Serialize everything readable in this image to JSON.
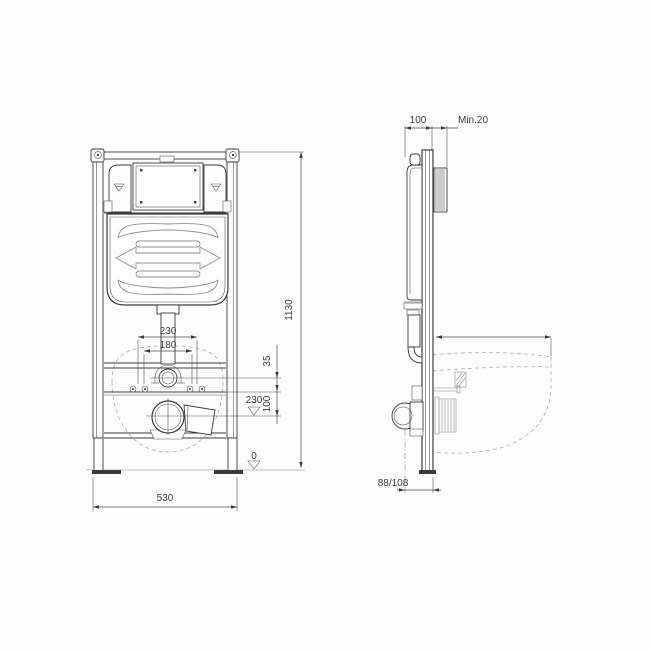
{
  "labels": {
    "front_view": {
      "bolt_spacing_outer": "230",
      "bolt_spacing_inner": "180",
      "flush_to_fixings": "35",
      "fixings_to_outlet": "100",
      "outlet_height_level": "230",
      "floor_level": "0",
      "frame_width": "530",
      "frame_height": "1130"
    },
    "side_view": {
      "frame_depth": "100",
      "wall_clearance_min": "Min.20",
      "outlet_offset": "88/108"
    }
  }
}
